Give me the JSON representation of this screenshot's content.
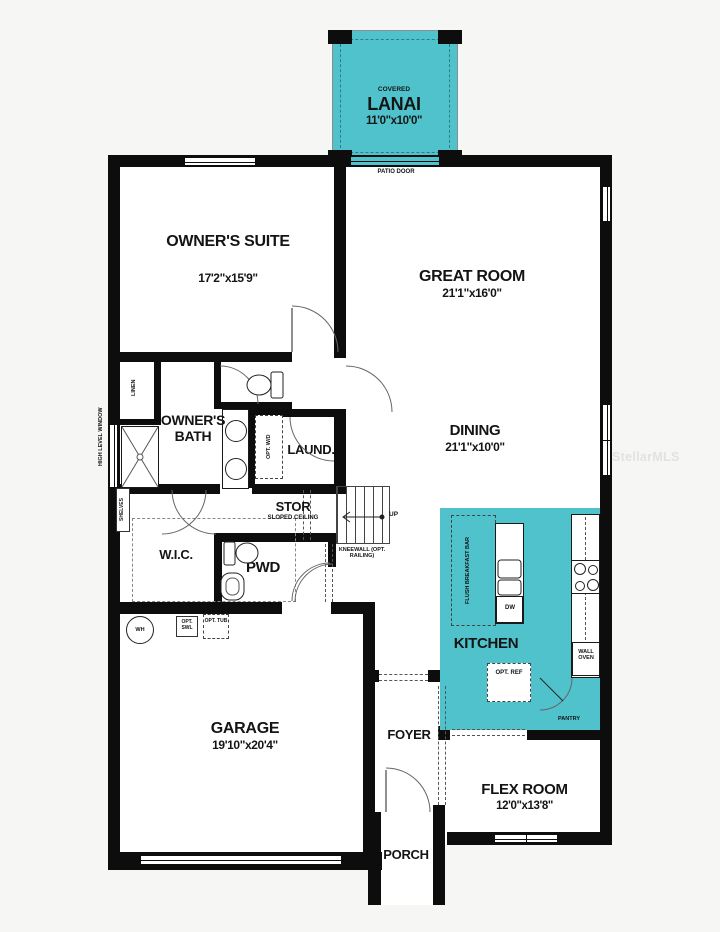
{
  "colors": {
    "accent_teal": "#4fc2cc",
    "wall_black": "#0d0d0d",
    "watermark_gray": "#e2e2e2"
  },
  "watermark": "StellarMLS",
  "rooms": {
    "lanai": {
      "prefix": "COVERED",
      "name": "LANAI",
      "dims": "11'0\"x10'0\""
    },
    "owners_suite": {
      "name": "OWNER'S SUITE",
      "dims": "17'2\"x15'9\""
    },
    "great_room": {
      "name": "GREAT ROOM",
      "dims": "21'1\"x16'0\""
    },
    "dining": {
      "name": "DINING",
      "dims": "21'1\"x10'0\""
    },
    "owners_bath": {
      "name": "OWNER'S BATH"
    },
    "laundry": {
      "name": "LAUND."
    },
    "storage": {
      "name": "STOR",
      "note": "SLOPED CEILING"
    },
    "wic": {
      "name": "W.I.C."
    },
    "powder": {
      "name": "PWD"
    },
    "kitchen": {
      "name": "KITCHEN"
    },
    "pantry": {
      "name": "PANTRY"
    },
    "garage": {
      "name": "GARAGE",
      "dims": "19'10\"x20'4\""
    },
    "foyer": {
      "name": "FOYER"
    },
    "porch": {
      "name": "PORCH"
    },
    "flex_room": {
      "name": "FLEX ROOM",
      "dims": "12'0\"x13'8\""
    }
  },
  "annotations": {
    "patio_door": "PATIO DOOR",
    "high_level_window": "HIGH LEVEL WINDOW",
    "linen": "LINEN",
    "shelves": "SHELVES",
    "opt_wd": "OPT. W/D",
    "up": "UP",
    "kneewall": "KNEEWALL (OPT. RAILING)",
    "flush_breakfast_bar": "FLUSH BREAKFAST BAR",
    "dw": "DW",
    "wall_oven": "WALL OVEN",
    "opt_ref": "OPT. REF",
    "water_heater": "WH",
    "opt_swl": "OPT. SWL",
    "opt_tub": "OPT. TUB"
  }
}
